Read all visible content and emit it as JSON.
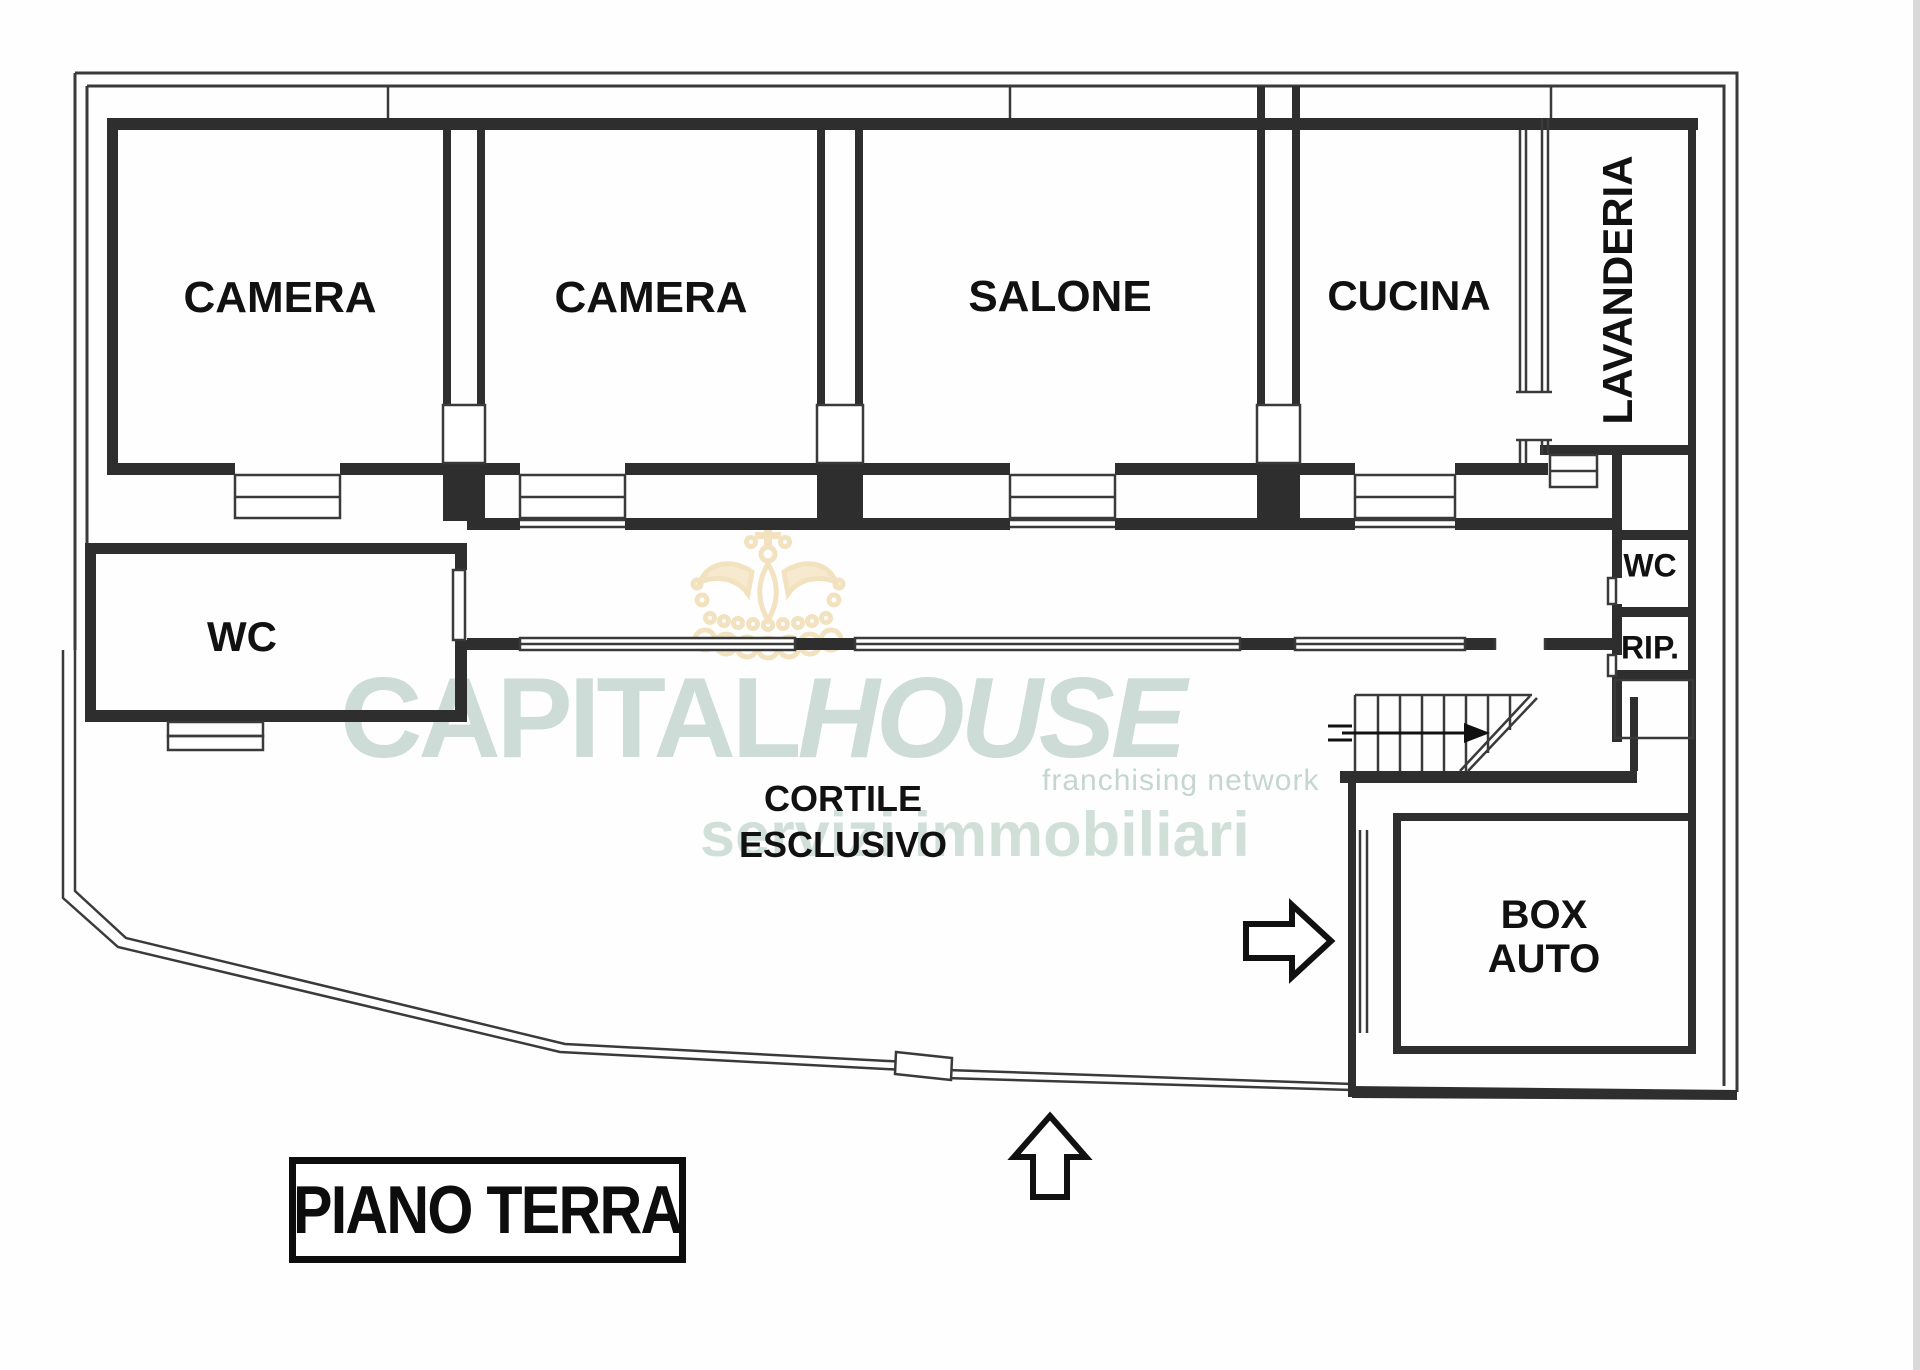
{
  "plan": {
    "title": "PIANO TERRA",
    "rooms": {
      "camera1": "CAMERA",
      "camera2": "CAMERA",
      "salone": "SALONE",
      "cucina": "CUCINA",
      "lavanderia": "LAVANDERIA",
      "wc_left": "WC",
      "wc_right": "WC",
      "rip": "RIP.",
      "cortile_line1": "CORTILE",
      "cortile_line2": "ESCLUSIVO",
      "box_line1": "BOX",
      "box_line2": "AUTO"
    },
    "colors": {
      "wall": "#2e2e2e",
      "line": "#3a3a3a",
      "label": "#111111"
    }
  },
  "watermark": {
    "brand_part1": "CAPITAL",
    "brand_part2": "HOUSE",
    "tagline": "franchising network",
    "subtitle": "servizi immobiliari",
    "text_color": "#cddcd6",
    "crown_color": "#f2e1bd"
  }
}
